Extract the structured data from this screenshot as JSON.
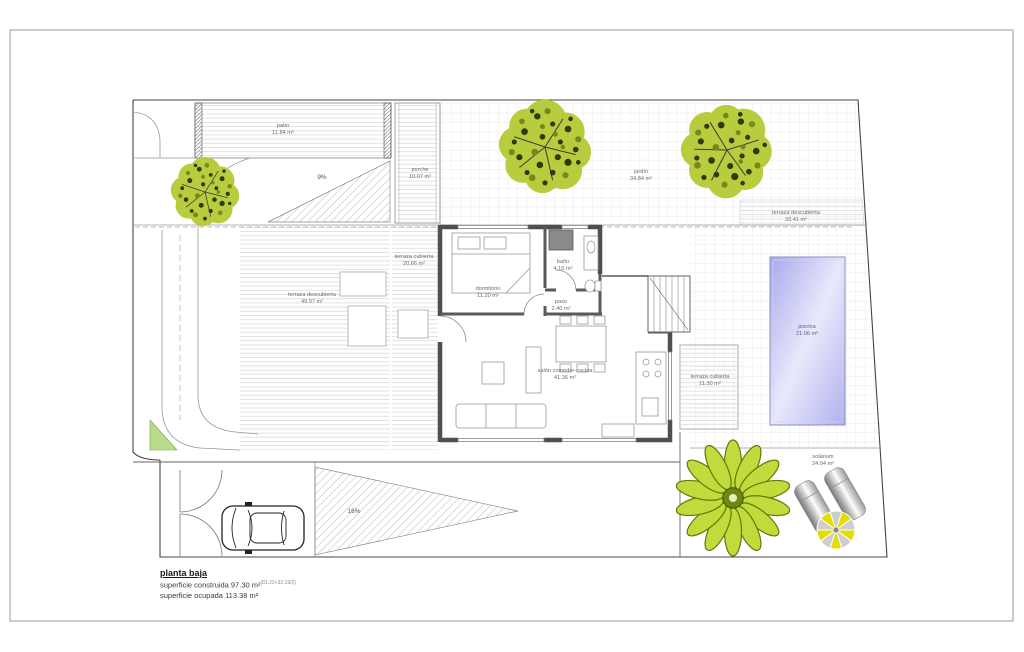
{
  "footer": {
    "title": "planta baja",
    "built_label": "superficie construida",
    "built_value": "97.30 m²",
    "built_note": "(81.22+32.19/2)",
    "occupied_label": "superficie ocupada",
    "occupied_value": "113.38 m²"
  },
  "rooms": {
    "patio": {
      "name": "patio",
      "area": "11.84 m²"
    },
    "porche": {
      "name": "porche",
      "area": "10.07 m²"
    },
    "terraza_descubierta_izq": {
      "name": "terraza descubierta",
      "area": "49.97 m²"
    },
    "terraza_cubierta_izq": {
      "name": "terraza cubierta",
      "area": "20.66 m²"
    },
    "dormitorio": {
      "name": "dormitorio",
      "area": "11.20 m²"
    },
    "bano": {
      "name": "baño",
      "area": "4.15 m²"
    },
    "paso": {
      "name": "paso",
      "area": "2.40 m²"
    },
    "salon": {
      "name": "salón comedor-cocina",
      "area": "41.36 m²"
    },
    "terraza_cubierta_der": {
      "name": "terraza cubierta",
      "area": "11.30 m²"
    },
    "jardin": {
      "name": "jardín",
      "area": "34.84 m²"
    },
    "terraza_descubierta_sup": {
      "name": "terraza descubierta",
      "area": "33.41 m²"
    },
    "piscina": {
      "name": "piscina",
      "area": "21.06 m²"
    },
    "solarium": {
      "name": "solárium",
      "area": "24.04 m²"
    }
  },
  "annotations": {
    "slope_top": "9%",
    "slope_bottom": "16%"
  },
  "colors": {
    "tree_green": "#b9cc3e",
    "tree_spot_dark": "#2c3c08",
    "tree_spot_mid": "#74891c",
    "palm_green": "#c3da3c",
    "palm_outline": "#5e7c08",
    "pool_fill": "#b8b8f0",
    "grass_triangle": "#b8dc8c",
    "parasol_yellow": "#e4de00",
    "setback_pink": "#e0a0c8",
    "wall_gray": "#4f4f4f"
  }
}
